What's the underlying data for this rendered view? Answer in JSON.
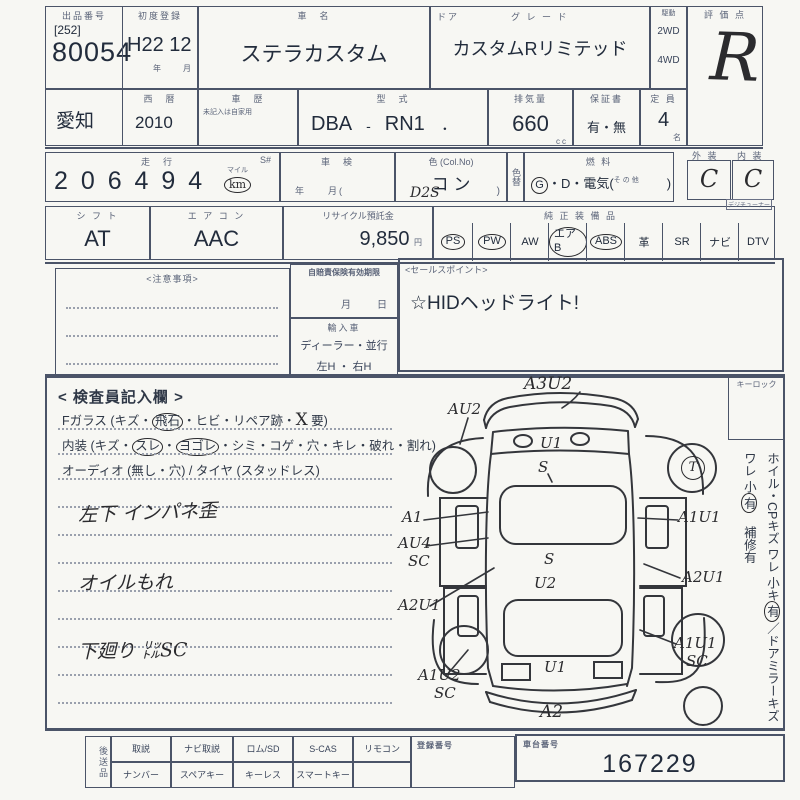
{
  "header": {
    "auction_no_label": "出品番号",
    "auction_no_bracket": "[252]",
    "auction_no": "80054",
    "first_reg_label": "初度登録",
    "first_reg_value": "H22 12",
    "first_reg_units": "年　　月",
    "car_name_label": "車　名",
    "car_name": "ステラカスタム",
    "door_label": "ドア",
    "grade_label": "グ レ ー ド",
    "grade": "カスタムRリミテッド",
    "drive_label": "駆動",
    "drive_2wd": "2WD",
    "drive_4wd": "4WD",
    "score_label": "評 価 点",
    "score": "R"
  },
  "row2": {
    "prefecture": "愛知",
    "calendar_label": "西　暦",
    "calendar_year": "2010",
    "history_label": "車　歴",
    "history_note": "未記入は自家用",
    "model_label": "型　式",
    "model_code": "DBA",
    "model_sep": "-",
    "model_value": "RN1",
    "model_dot": "・",
    "disp_label": "排気量",
    "disp_value": "660",
    "disp_unit": "cc",
    "warranty_label": "保証書",
    "warranty_value": "有・無",
    "capacity_label": "定 員",
    "capacity_value": "4",
    "capacity_unit": "名"
  },
  "row3": {
    "mileage_label": "走　行",
    "s_label": "S#",
    "mileage_digits": "2 0 6  4 9 4",
    "mile_label": "マイル",
    "km_label": "km",
    "shaken_label": "車　検",
    "shaken_units": "年　　月(",
    "color_label": "色 (Col.No)",
    "color_value": "コ  ン",
    "color_code_hw": "D2S",
    "paren_close": ")",
    "color_change_label": "色替",
    "fuel_label": "燃  料",
    "fuel_g": "G",
    "fuel_rest": "・D・電気(",
    "fuel_other": "その他",
    "fuel_close": ")",
    "exterior_label": "外 装",
    "exterior_grade": "C",
    "interior_label": "内 装",
    "interior_grade": "C"
  },
  "row4": {
    "shift_label": "シ フ ト",
    "shift_value": "AT",
    "aircon_label": "エ ア コ ン",
    "aircon_value": "AAC",
    "recycle_label": "リサイクル預託金",
    "recycle_value": "9,850",
    "recycle_unit": "円",
    "equip_label": "純 正 装 備 品",
    "tuner_note": "デジチューナー",
    "items": [
      {
        "label": "PS",
        "circled": true
      },
      {
        "label": "PW",
        "circled": true
      },
      {
        "label": "AW",
        "circled": false
      },
      {
        "label": "エアB",
        "circled": true
      },
      {
        "label": "ABS",
        "circled": true
      },
      {
        "label": "革",
        "circled": false
      },
      {
        "label": "SR",
        "circled": false
      },
      {
        "label": "ナビ",
        "circled": false
      },
      {
        "label": "DTV",
        "circled": false
      }
    ]
  },
  "mid": {
    "notes_label": "<注意事項>",
    "insurance_label": "自賠責保険有効期限",
    "insurance_units": "月　　日",
    "import_label": "輸入車",
    "import_type": "ディーラー・並行",
    "handle": "左H ・ 右H",
    "sales_label": "<セールスポイント>",
    "sales_text": "☆HIDヘッドライト!"
  },
  "inspect": {
    "title": "< 検査員記入欄 >",
    "l1_pre": "Fガラス (キズ・",
    "l1_circled": "飛石",
    "l1_mid": "・ヒビ・リペア跡・",
    "l1_x": "X",
    "l1_end": "要)",
    "l2_pre": "内装 (キズ・",
    "l2_c1": "スレ",
    "l2_dot": "・",
    "l2_c2": "ヨゴレ",
    "l2_end": "・シミ・コゲ・穴・キレ・破れ・割れ)",
    "l3": "オーディオ (無し・穴) / タイヤ (スタッドレス)",
    "hw1": "左下 インパネ歪",
    "hw2": "オイルもれ",
    "hw3": "下廻り ㍑SC"
  },
  "side": {
    "keylock_label": "キーロック",
    "wheel_note": "ホイル・CPキズ ワレ 小キ",
    "wheel_mark": "有",
    "sep": "／",
    "mirror_note": "ドアミラーキズ ワレ 小",
    "mirror_mark": "有",
    "repair_note": "補修有"
  },
  "diagram": {
    "front_bumper": "A3U2",
    "lf_fender": "AU2",
    "hood1": "U1",
    "hood2": "S",
    "rf_wheel": "T",
    "l_front_door": "A1",
    "l_mid1": "AU4",
    "l_mid2": "SC",
    "l_rear_door": "A2U1",
    "roof1": "S",
    "roof2": "U2",
    "r_front_door": "A1U1",
    "r_rear_door": "A2U1",
    "r_rear_fender1": "A1U1",
    "r_rear_fender2": "SC",
    "l_rear_fender1": "A1U2",
    "l_rear_fender2": "SC",
    "rear_gate": "U1",
    "rear_bumper": "A2"
  },
  "bottom": {
    "send_label": "後送品",
    "r1c1": "取説",
    "r1c2": "ナビ取説",
    "r1c3": "ロム/SD",
    "r1c4": "S-CAS",
    "r1c5": "リモコン",
    "reg_label": "登録番号",
    "r2c1": "ナンバー",
    "r2c2": "スペアキー",
    "r2c3": "キーレス",
    "r2c4": "スマートキー",
    "chassis_label": "車台番号",
    "chassis_no": "167229"
  }
}
